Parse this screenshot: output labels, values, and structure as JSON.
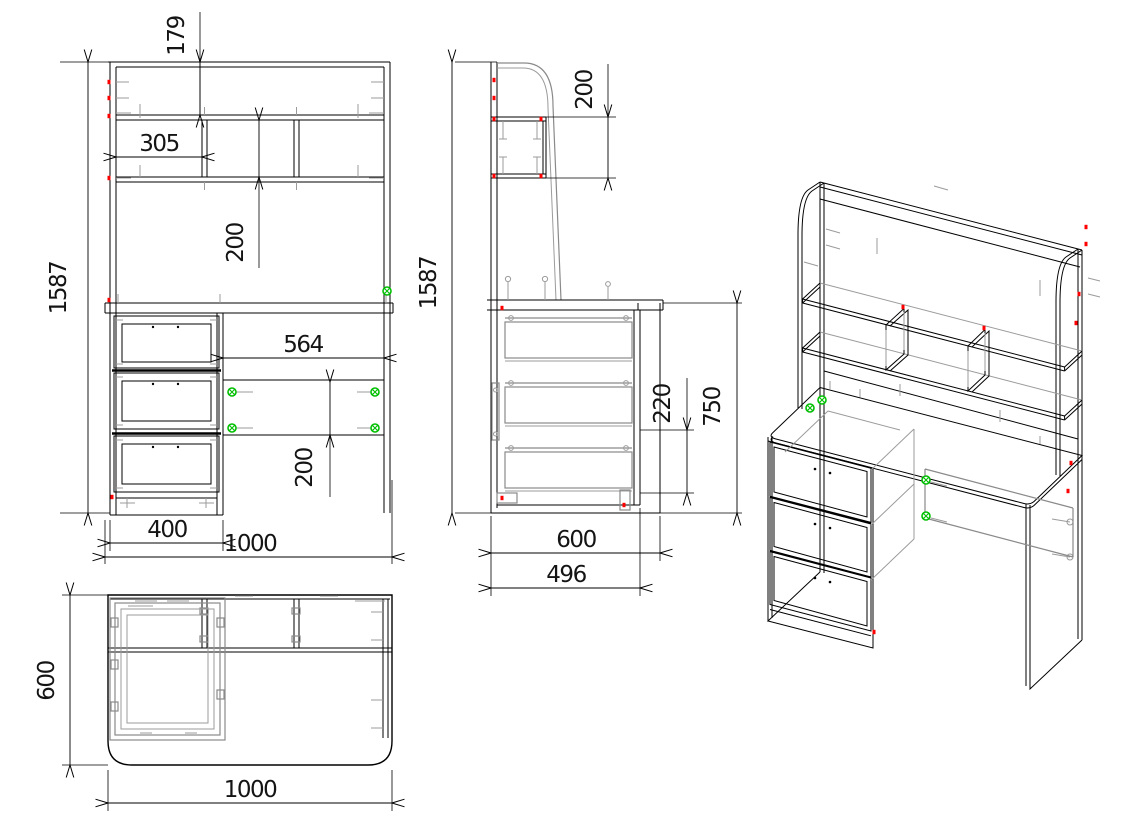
{
  "colors": {
    "outline": "#000000",
    "hardware_gray": "#9b9b9b",
    "fastener_red": "#ff0000",
    "fastener_green": "#00bf00",
    "background": "#ffffff"
  },
  "views": {
    "front": {
      "dims": {
        "total_height": "1587",
        "hutch_top_offset": "179",
        "shelf_compartment_width": "305",
        "shelf_opening_height": "200",
        "desk_opening_width": "564",
        "back_panel_height": "200",
        "drawer_unit_width": "400",
        "total_width": "1000"
      }
    },
    "side": {
      "dims": {
        "total_height": "1587",
        "shelf_depth": "200",
        "drawer_pitch": "220",
        "desk_height": "750",
        "total_depth": "600",
        "drawer_unit_depth": "496"
      }
    },
    "top": {
      "dims": {
        "total_depth": "600",
        "total_width": "1000"
      }
    }
  }
}
